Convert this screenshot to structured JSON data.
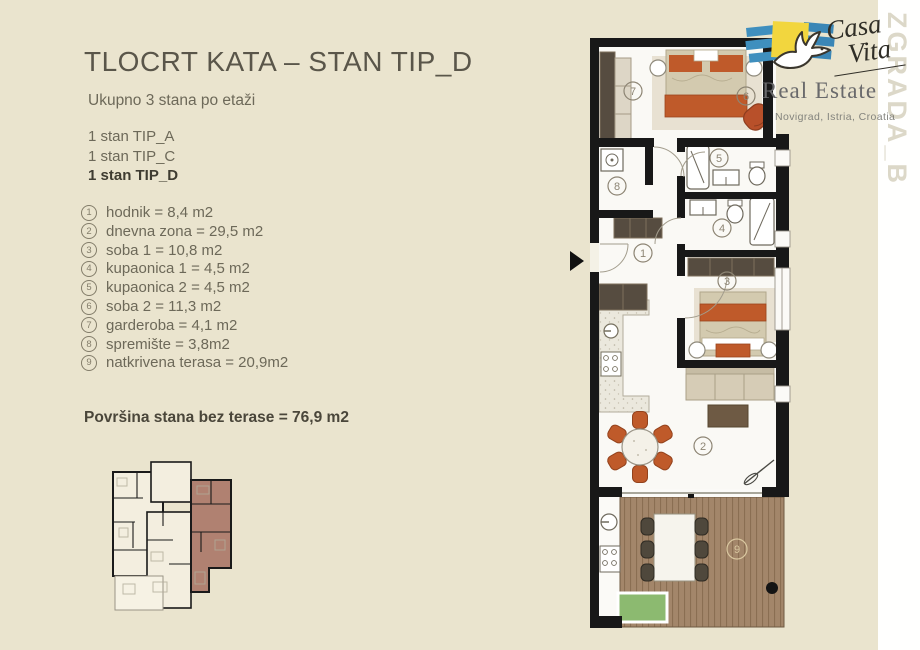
{
  "page": {
    "title": "TLOCRT KATA – STAN TIP_D",
    "building_label": "ZGRADA_B",
    "background": "#eae4ce"
  },
  "summary": {
    "subtitle": "Ukupno 3 stana po etaži",
    "units": [
      {
        "label": "1 stan TIP_A",
        "bold": false
      },
      {
        "label": "1 stan TIP_C",
        "bold": false
      },
      {
        "label": "1 stan TIP_D",
        "bold": true
      }
    ]
  },
  "rooms": [
    {
      "num": "1",
      "label": "hodnik = 8,4 m2"
    },
    {
      "num": "2",
      "label": "dnevna zona = 29,5 m2"
    },
    {
      "num": "3",
      "label": "soba 1 = 10,8 m2"
    },
    {
      "num": "4",
      "label": "kupaonica 1 = 4,5 m2"
    },
    {
      "num": "5",
      "label": "kupaonica 2 = 4,5 m2"
    },
    {
      "num": "6",
      "label": "soba 2 = 11,3 m2"
    },
    {
      "num": "7",
      "label": "garderoba = 4,1 m2"
    },
    {
      "num": "8",
      "label": "spremište = 3,8m2"
    },
    {
      "num": "9",
      "label": "natkrivena terasa = 20,9m2"
    }
  ],
  "total_label": "Površina stana bez terase = 76,9 m2",
  "branding": {
    "brand_line1": "Casa",
    "brand_line2": "Vita",
    "division": "Real Estate",
    "location": "Novigrad, Istria, Croatia"
  },
  "palette": {
    "accent_orange": "#bf5a2a",
    "deck_wood": "#a3866a",
    "unit_highlight": "#b08171",
    "brand_blue": "#3f8fbe",
    "brand_yellow": "#f2d63e",
    "terrace_label": "#d9c7a0"
  }
}
